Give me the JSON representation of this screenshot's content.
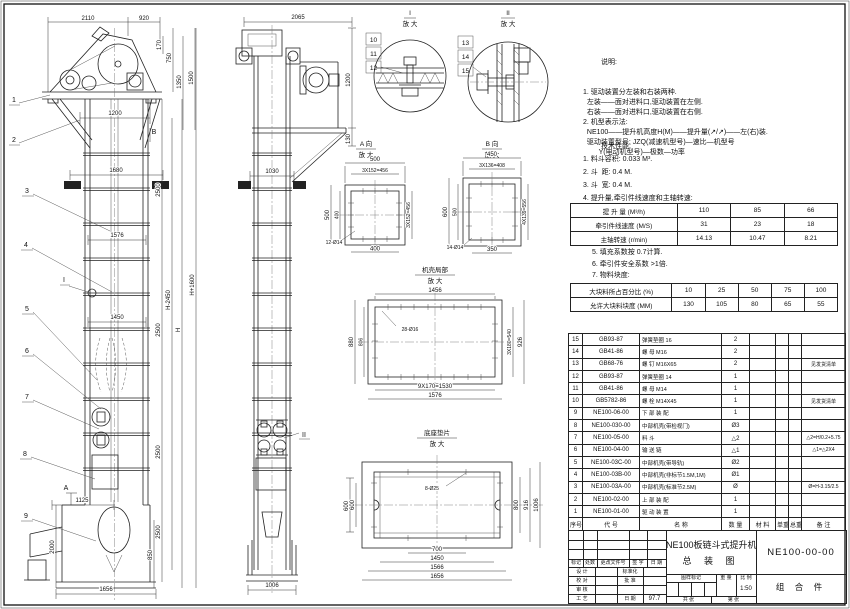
{
  "front": {
    "parts": [
      "1",
      "2",
      "3",
      "4",
      "5",
      "6",
      "7",
      "8",
      "9"
    ],
    "markers": {
      "i": "I",
      "a": "A",
      "b": "B"
    },
    "dims": {
      "d2110": "2110",
      "d920": "920",
      "d170": "170",
      "d750": "750",
      "d1350": "1350",
      "d1500": "1500",
      "d1200": "1200",
      "d1680": "1680",
      "d1576": "1576",
      "d1450": "1450",
      "d1125": "1125",
      "d2000": "2000",
      "d850": "850",
      "d1656": "1656",
      "c2500a": "2500",
      "c2500b": "2500",
      "c2500c": "2500",
      "c2500d": "2500",
      "h1": "H-2450",
      "h2": "H",
      "h3": "H+1600"
    }
  },
  "side": {
    "marker": "II",
    "dims": {
      "d2065": "2065",
      "d1200": "1200",
      "d130": "130",
      "d1030": "1030",
      "d600": "600",
      "d1006": "1006"
    }
  },
  "details": {
    "i": {
      "title": "I",
      "sub": "放 大",
      "parts": [
        "10",
        "11",
        "12"
      ]
    },
    "ii": {
      "title": "II",
      "sub": "放 大",
      "parts": [
        "13",
        "14",
        "15"
      ]
    },
    "a": {
      "title": "A 向",
      "sub": "放 大",
      "d500t": "500",
      "dpt": "3X152=456",
      "d500l": "500",
      "d400l": "400",
      "dpr": "3X152=456",
      "d400b": "400",
      "holes": "12-Ø14"
    },
    "b": {
      "title": "B 向",
      "sub": "放 大",
      "d450": "450",
      "dpt": "3X136=408",
      "d600": "600",
      "d500": "500",
      "dpr": "4X139=556",
      "d350": "350",
      "holes": "14-Ø14"
    },
    "casing": {
      "title": "机壳局部",
      "sub": "放 大",
      "d1456": "1456",
      "holes": "28-Ø16",
      "d880": "880",
      "d806": "806",
      "dp": "3X180=540",
      "d926": "926",
      "db": "9X170=1530",
      "d1576": "1576"
    },
    "base": {
      "title": "底座垫片",
      "sub": "放 大",
      "holes": "8-Ø25",
      "d600": "600",
      "d800": "800",
      "d916": "916",
      "d1006": "1006",
      "d700": "700",
      "d1450": "1450",
      "d1566": "1566",
      "d1656": "1656"
    }
  },
  "notes": {
    "title": "说明:",
    "lines": [
      "1. 驱动装置分左装和右装两种.",
      "  左装——面对进料口,驱动装置在左侧.",
      "  右装——面对进料口,驱动装置在右侧.",
      "2. 机型表示法:",
      "  NE100——提升机高度H(M)——提升量(↗/↗)——左(右)装.",
      "  驱动装置型号: JZQ(减速机型号)—速比—机型号",
      "        Y(电动机型号)—极数—功率"
    ],
    "tech_title": "技术性能:",
    "tech_lines": [
      "1. 料斗容积: 0.033 M³.",
      "2. 斗  距: 0.4 M.",
      "3. 斗  宽: 0.4 M.",
      "4. 提升量,牵引件线速度和主轴转速:"
    ],
    "post_lines": [
      "5. 填充系数按 0.7计算.",
      "6. 牵引件安全系数 >1倍.",
      "7. 物料块度:"
    ]
  },
  "perf_table": {
    "rows": [
      [
        "提 升 量 (M³/h)",
        "110",
        "85",
        "66"
      ],
      [
        "牵引件线速度 (M/S)",
        "31",
        "23",
        "18"
      ],
      [
        "主轴转速 (r/min)",
        "14.13",
        "10.47",
        "8.21"
      ]
    ]
  },
  "block_table": {
    "rows": [
      [
        "大块料所占百分比 (%)",
        "10",
        "25",
        "50",
        "75",
        "100"
      ],
      [
        "允许大块料块度 (MM)",
        "130",
        "105",
        "80",
        "65",
        "55"
      ]
    ]
  },
  "bom": {
    "header": [
      [
        "序号",
        "代  号",
        "名  称",
        "数 量",
        "材  料",
        "单重",
        "总重",
        "备  注"
      ]
    ],
    "rows": [
      [
        "15",
        "GB93-87",
        "弹簧垫圈  16",
        "2",
        "",
        "",
        "",
        ""
      ],
      [
        "14",
        "GB41-86",
        "螺 母  M16",
        "2",
        "",
        "",
        "",
        ""
      ],
      [
        "13",
        "GB68-76",
        "螺 钉  M16X65",
        "2",
        "",
        "",
        "",
        "见发货清单"
      ],
      [
        "12",
        "GB93-87",
        "弹簧垫圈  14",
        "1",
        "",
        "",
        "",
        ""
      ],
      [
        "11",
        "GB41-86",
        "螺 母  M14",
        "1",
        "",
        "",
        "",
        ""
      ],
      [
        "10",
        "GB5782-86",
        "螺 栓  M14X45",
        "1",
        "",
        "",
        "",
        "见发货清单"
      ],
      [
        "9",
        "NE100-06-00",
        "下 部 装 配",
        "1",
        "",
        "",
        "",
        ""
      ],
      [
        "8",
        "NE100-030-00",
        "中部机壳(带检视门)",
        "Ø3",
        "",
        "",
        "",
        ""
      ],
      [
        "7",
        "NE100-05-00",
        "料  斗",
        "△2",
        "",
        "",
        "",
        "△2=H/0.2+5.75"
      ],
      [
        "6",
        "NE100-04-00",
        "输 送 链",
        "△1",
        "",
        "",
        "",
        "△1=△2X4"
      ],
      [
        "5",
        "NE100-03C-00",
        "中部机壳(带导轨)",
        "Ø2",
        "",
        "",
        "",
        ""
      ],
      [
        "4",
        "NE100-03B-00",
        "中部机壳(非标节1.5M,1M)",
        "Ø1",
        "",
        "",
        "",
        ""
      ],
      [
        "3",
        "NE100-03A-00",
        "中部机壳(标准节2.5M)",
        "Ø",
        "",
        "",
        "",
        "Ø=H-3.15/2.5"
      ],
      [
        "2",
        "NE100-02-00",
        "上 部 装 配",
        "1",
        "",
        "",
        "",
        ""
      ],
      [
        "1",
        "NE100-01-00",
        "驱 动 装 置",
        "1",
        "",
        "",
        "",
        ""
      ]
    ]
  },
  "title_block": {
    "rev_cols": [
      "标记",
      "处数",
      "更改文件号",
      "签 字",
      "日 期"
    ],
    "roles": [
      [
        "设 计",
        "标准化",
        ""
      ],
      [
        "校 对",
        "批 准",
        ""
      ],
      [
        "审 核",
        "",
        ""
      ],
      [
        "工 艺",
        "日 期",
        "97.7"
      ]
    ],
    "title_line1": "NE100板链斗式提升机",
    "title_line2": "总  装  图",
    "drawing_no": "NE100-00-00",
    "part_class": "组 合 件",
    "stamp_cols": [
      "图样标记",
      "重 量",
      "比 例"
    ],
    "scale": "1:50",
    "sheets_total": "共  张",
    "sheets_no": "第  张"
  }
}
